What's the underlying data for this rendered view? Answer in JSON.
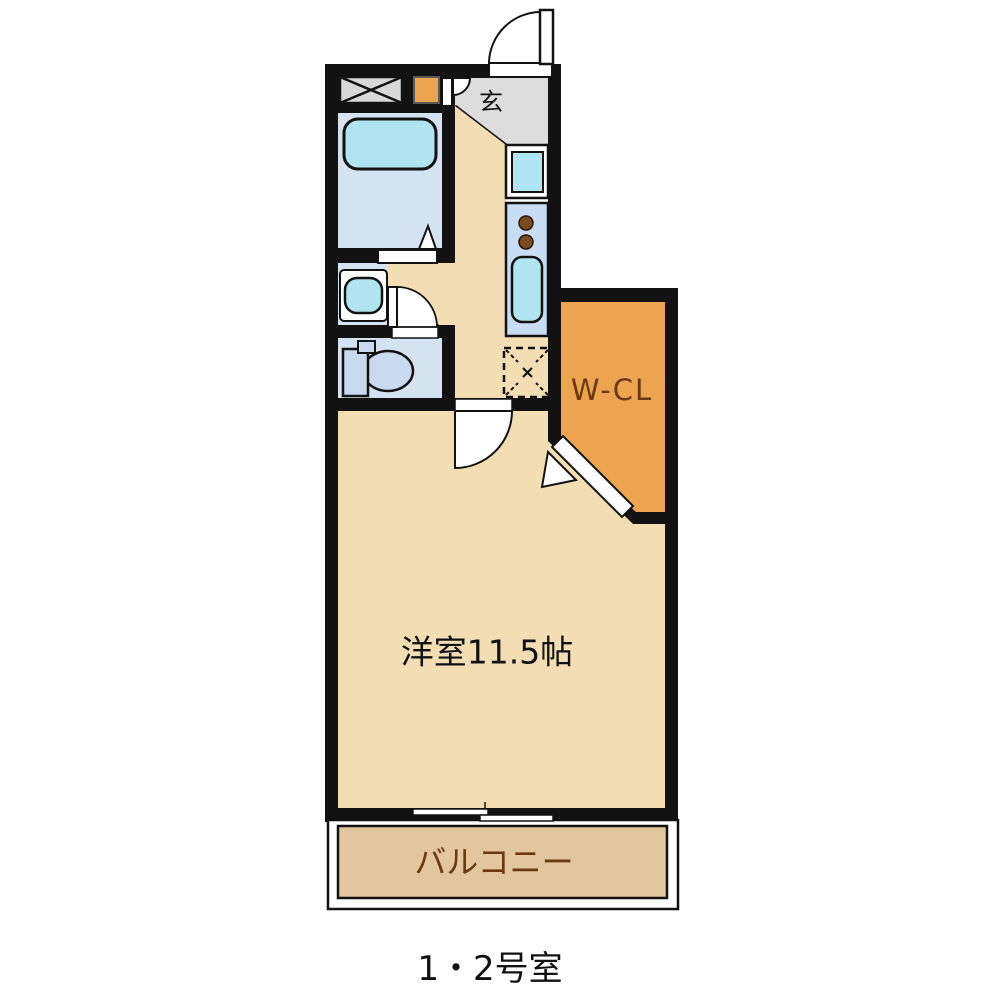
{
  "floorplan": {
    "caption": "1・2号室",
    "rooms": {
      "entrance": {
        "label": "玄"
      },
      "walk_in_closet": {
        "label": "W-CL"
      },
      "main_room": {
        "label": "洋室11.5帖"
      },
      "balcony": {
        "label": "バルコニー"
      }
    },
    "colors": {
      "wall": "#121212",
      "room_tan": "#f3ddb2",
      "balcony_tan": "#e2c69e",
      "closet_orange": "#eca44f",
      "entrance_gray": "#dcdcdc",
      "wet_floor_blue": "#d5e3f0",
      "fixture_cyan": "#b0e4f0",
      "counter_blue": "#c8dcf4",
      "toilet_blue": "#c8daf0",
      "burner_brown": "#7b4a1f",
      "label_brown": "#6b3a12",
      "caption_black": "#111111"
    }
  }
}
